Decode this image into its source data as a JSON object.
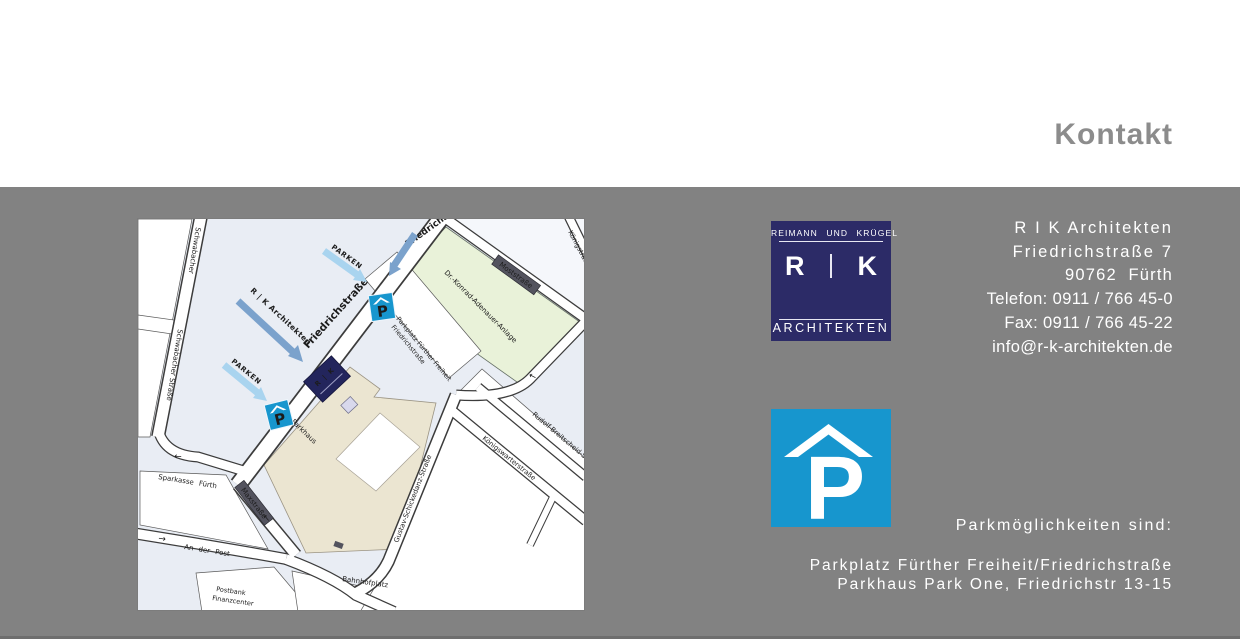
{
  "header": {
    "title": "Kontakt"
  },
  "logo": {
    "firm_line": "REIMANN UND KRÜGEL",
    "initial_left": "R",
    "initial_right": "K",
    "word_mark": "ARCHITEKTEN"
  },
  "contact": {
    "name": "R I K Architekten",
    "street": "Friedrichstraße 7",
    "city": "90762  Fürth",
    "phone": "Telefon: 0911 / 766 45-0",
    "fax": "Fax: 0911 / 766 45-22",
    "email": "info@r-k-architekten.de"
  },
  "parking": {
    "tile_letter": "P",
    "heading": "Parkmöglichkeiten sind:",
    "options": [
      "Parkplatz Fürther Freiheit/Friedrichstraße",
      "Parkhaus Park One, Friedrichstr 13-15"
    ]
  },
  "map": {
    "marker_letter": "P",
    "rk_marker": "R | K",
    "arrows": {
      "rk": "R | K Architekten",
      "parken_top": "PARKEN",
      "parken_bottom": "PARKEN"
    },
    "icons": {
      "one_way_left": "←",
      "one_way_right": "→"
    },
    "streets": {
      "schwabacher_top": "Schwabacher",
      "schwabacher": "Schwabacher Straße",
      "friedrich_top": "Friedrichstr",
      "friedrichstrasse": "Friedrichstraße",
      "moststrasse": "Moststraße",
      "koenigstrasse": "Königstraße",
      "maxstrasse": "Maxstraße",
      "an_der_post": "An der Post",
      "gustav": "Gustav-Schickedanz-Straße",
      "koenigswarter": "Königswarterstraße",
      "rudolf": "Rudolf-Breitscheid-Str."
    },
    "pois": {
      "adenauer": "Dr.-Konrad-Adenauer-Anlage",
      "parkplatz_line1": "Parkplatz Fürther Freiheit",
      "parkplatz_line2": "Friedrichstraße",
      "parkhaus": "Parkhaus",
      "sparkasse": "Sparkasse Fürth",
      "postbank_line1": "Postbank",
      "postbank_line2": "Finanzcenter",
      "bahnhofplatz": "Bahnhofplatz"
    }
  },
  "colors": {
    "page_gray": "#828282",
    "title_gray": "#8c8c8c",
    "navy": "#2c2b67",
    "tile_blue": "#1796ce",
    "map_bg": "#e9edf4",
    "arrow_light": "#a9d4ef",
    "arrow_steel": "#7ba2cc",
    "parken_text": "#3f9fd8"
  }
}
